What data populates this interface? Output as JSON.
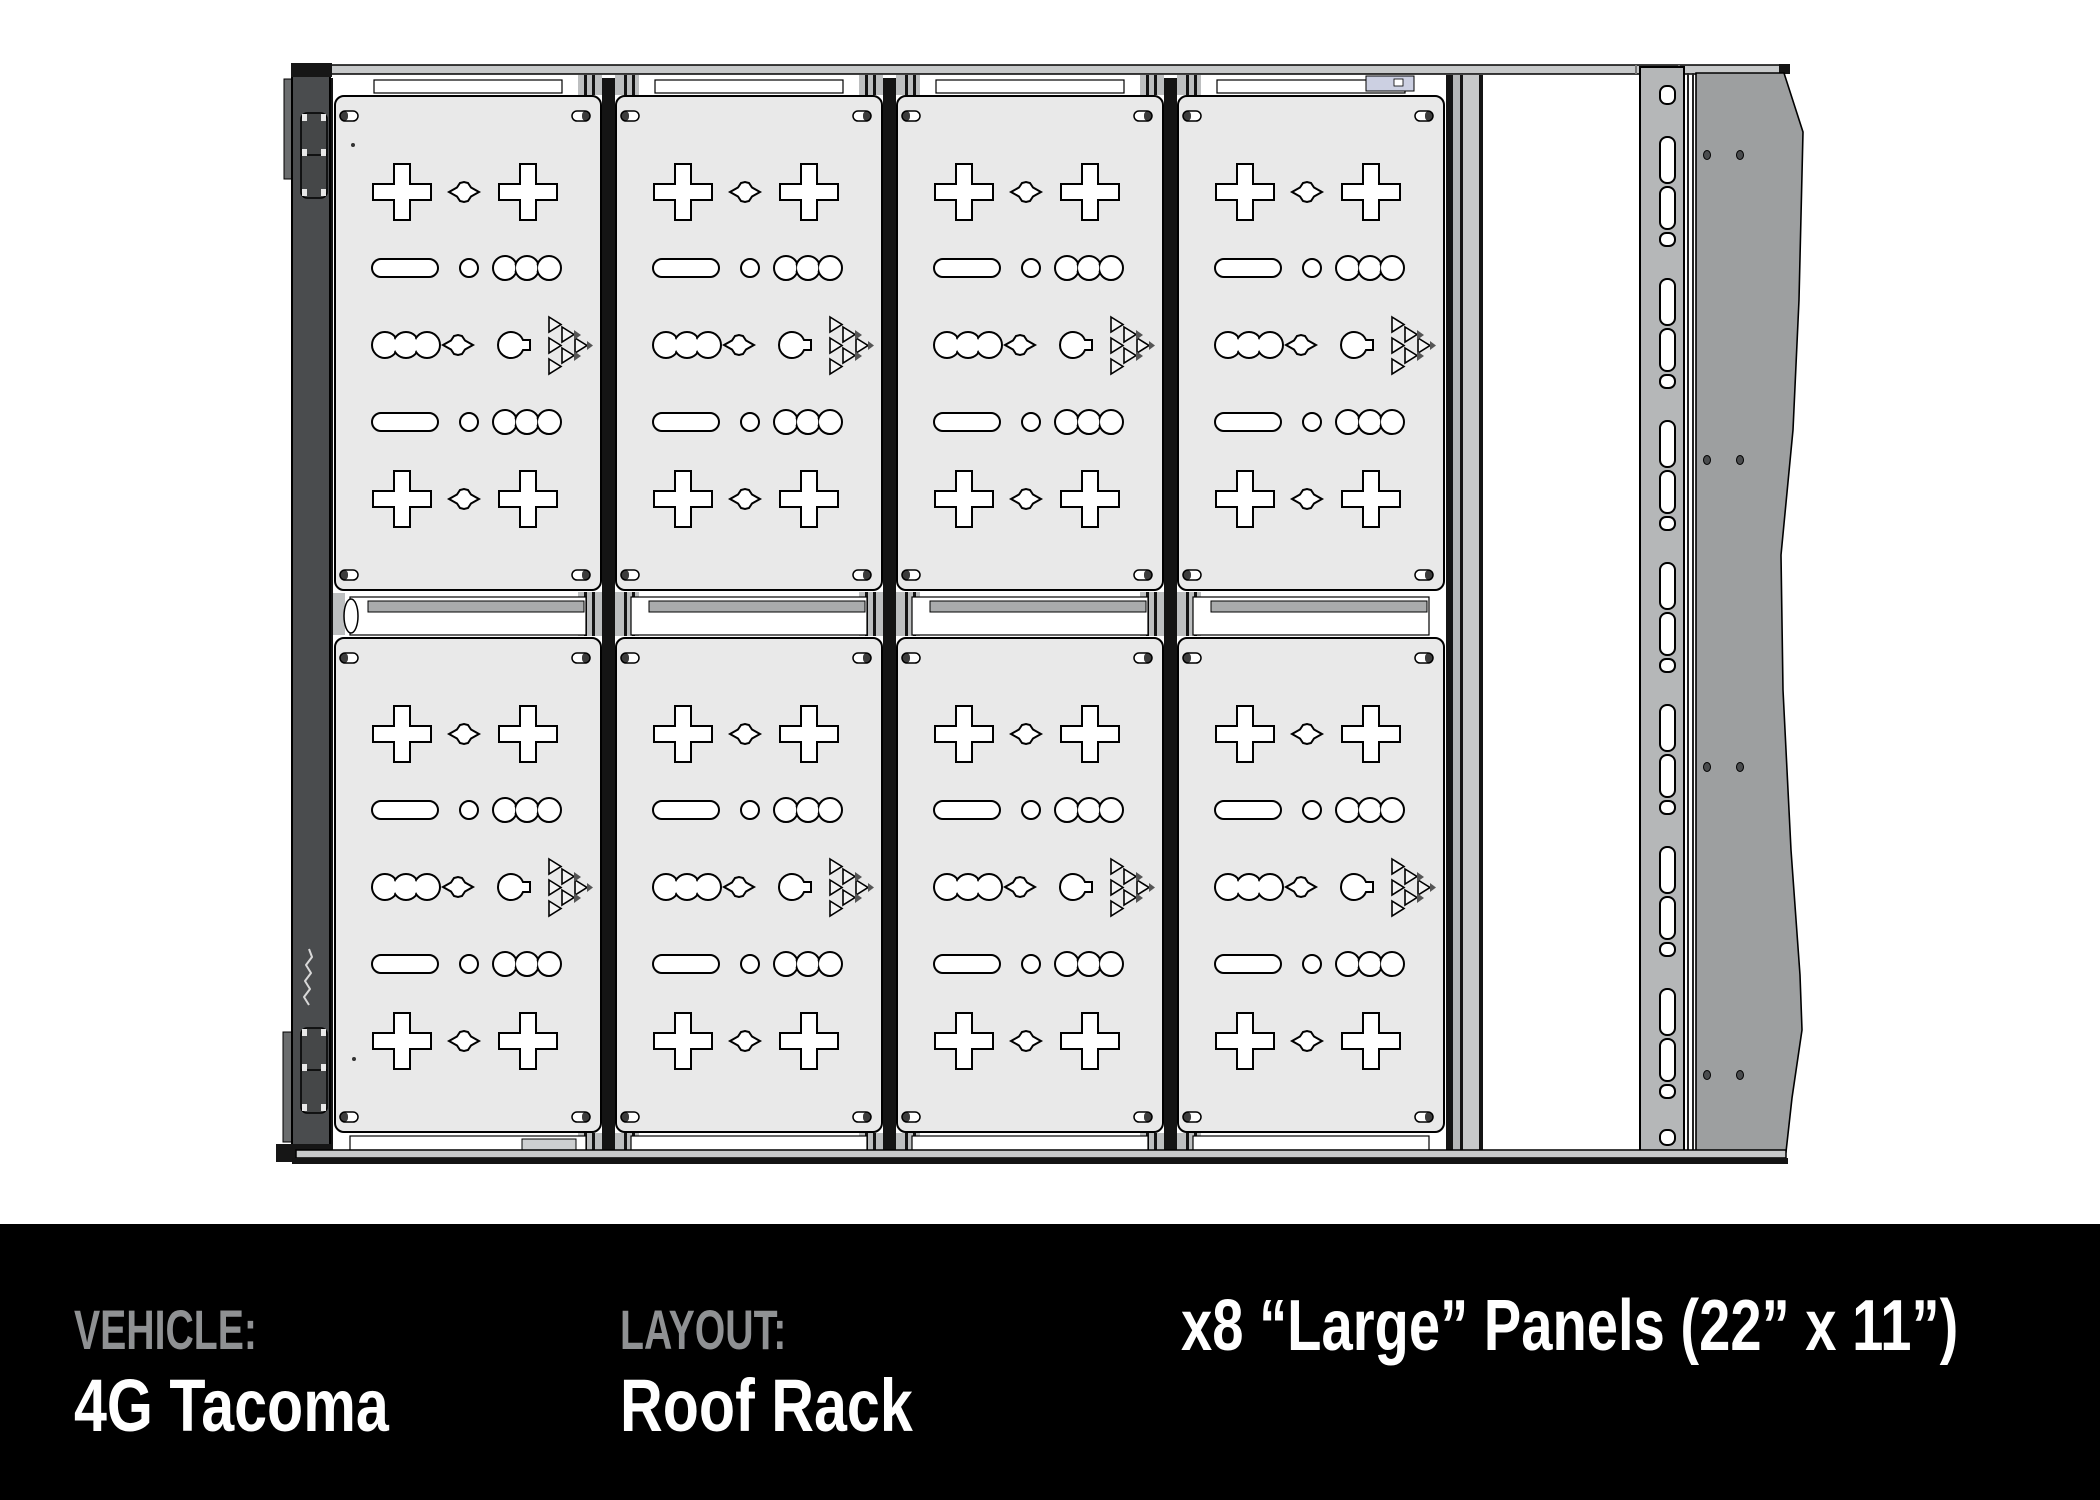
{
  "footer": {
    "vehicle_label": "VEHICLE:",
    "vehicle_value": "4G Tacoma",
    "layout_label": "LAYOUT:",
    "layout_value": "Roof Rack",
    "panels_note": "x8 “Large” Panels (22” x 11”)"
  },
  "diagram": {
    "view": "roof rack top view",
    "panel_count": 8,
    "panel_rows": 2,
    "panel_columns": 4
  },
  "colors": {
    "background": "#ffffff",
    "footer_bg": "#000000",
    "footer_label": "#8f9193",
    "footer_value": "#ffffff",
    "panel_fill": "#e9e9e9",
    "rail_dark": "#4a4c4e",
    "frame_gray": "#c7c9ca",
    "slotted_rail_gray": "#b5b7b8",
    "side_plate_gray": "#9d9fa0",
    "outline": "#000000",
    "accent_lavender": "#ccd0e2"
  }
}
